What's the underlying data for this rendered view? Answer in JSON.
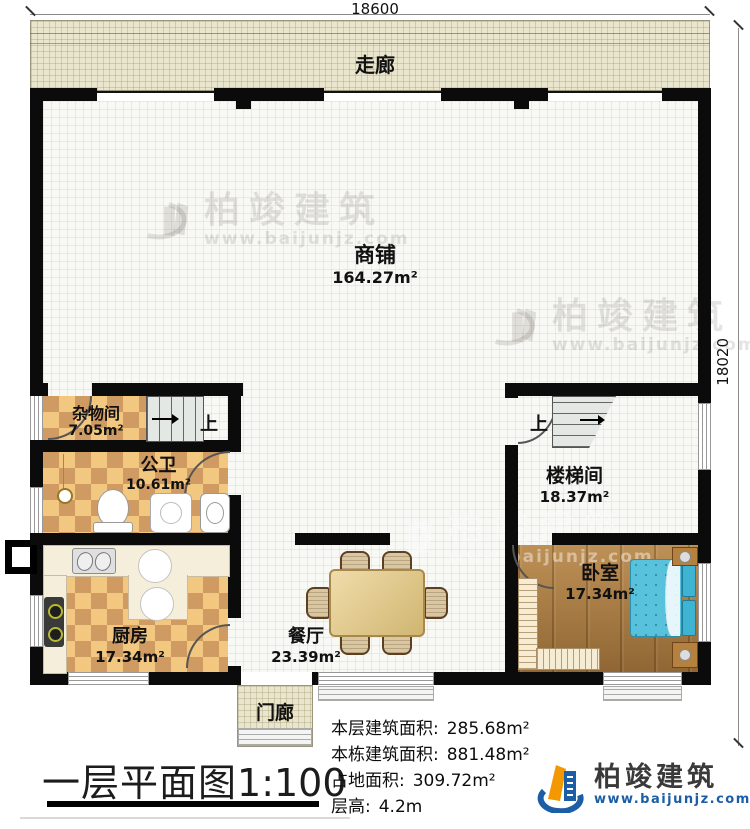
{
  "dimensions": {
    "top": "18600",
    "right": "18020"
  },
  "rooms": {
    "corridor": {
      "name": "走廊"
    },
    "shop": {
      "name": "商铺",
      "area": "164.27m²"
    },
    "storage": {
      "name": "杂物间",
      "area": "7.05m²"
    },
    "bathroom": {
      "name": "公卫",
      "area": "10.61m²"
    },
    "kitchen": {
      "name": "厨房",
      "area": "17.34m²"
    },
    "dining": {
      "name": "餐厅",
      "area": "23.39m²"
    },
    "stairwell": {
      "name": "楼梯间",
      "area": "18.37m²"
    },
    "bedroom": {
      "name": "卧室",
      "area": "17.34m²"
    },
    "porch": {
      "name": "门廊"
    }
  },
  "stairs": {
    "up_label": "上"
  },
  "title": {
    "text": "一层平面图",
    "scale": "1:100"
  },
  "stats": {
    "lines": [
      {
        "label": "本层建筑面积:",
        "value": "285.68m²"
      },
      {
        "label": "本栋建筑面积:",
        "value": "881.48m²"
      },
      {
        "label": "占地面积:",
        "value": "309.72m²"
      },
      {
        "label": "层高:",
        "value": "4.2m"
      }
    ]
  },
  "brand": {
    "name": "柏竣建筑",
    "website": "www.baijunjz.com"
  },
  "watermark": {
    "name": "柏竣建筑",
    "website": "www.baijunjz.com"
  },
  "colors": {
    "brand_blue": "#1b5ea6",
    "brand_orange": "#f39800",
    "wall": "#0b0b0b"
  }
}
